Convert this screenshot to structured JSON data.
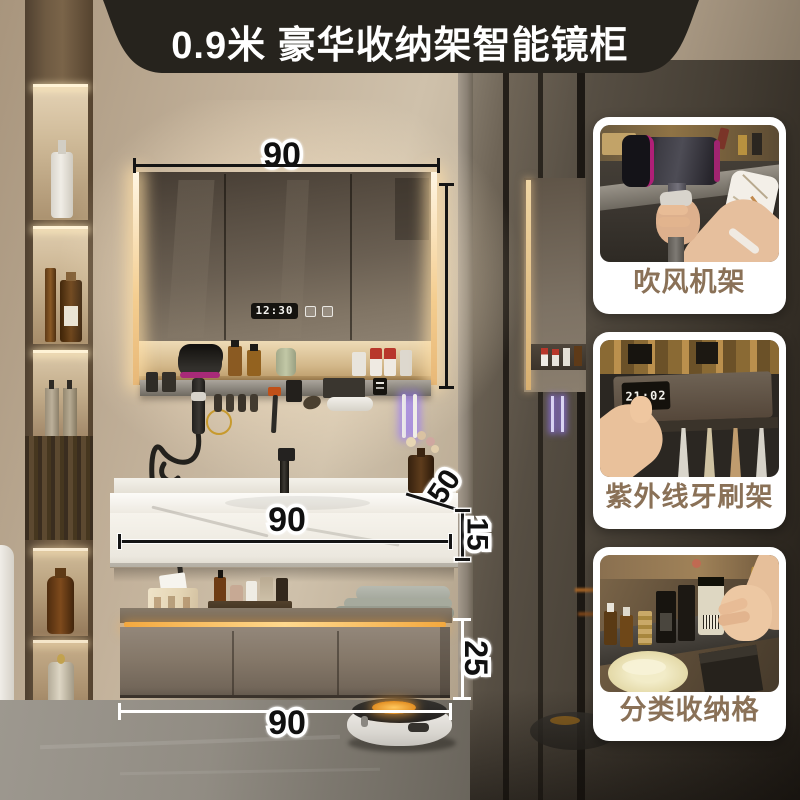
{
  "banner": {
    "title": "0.9米 豪华收纳架智能镜柜"
  },
  "mirror": {
    "clock_time": "12:30"
  },
  "dimensions": {
    "mirror_width": "90",
    "counter_depth": "50",
    "counter_thickness": "15",
    "counter_width": "90",
    "cabinet_height": "25",
    "cabinet_width": "90"
  },
  "cards": [
    {
      "label": "吹风机架"
    },
    {
      "label": "紫外线牙刷架",
      "device_time": "21:02"
    },
    {
      "label": "分类收纳格"
    }
  ],
  "colors": {
    "banner_bg": "#26231d",
    "banner_text": "#ffffff",
    "led_warm": "#f6cd8a",
    "cabinet_led": "#ffb84d",
    "card_bg": "#ffffff",
    "card_label": "#8a7157",
    "dim_dark": "#111111",
    "dim_light": "#ffffff"
  }
}
